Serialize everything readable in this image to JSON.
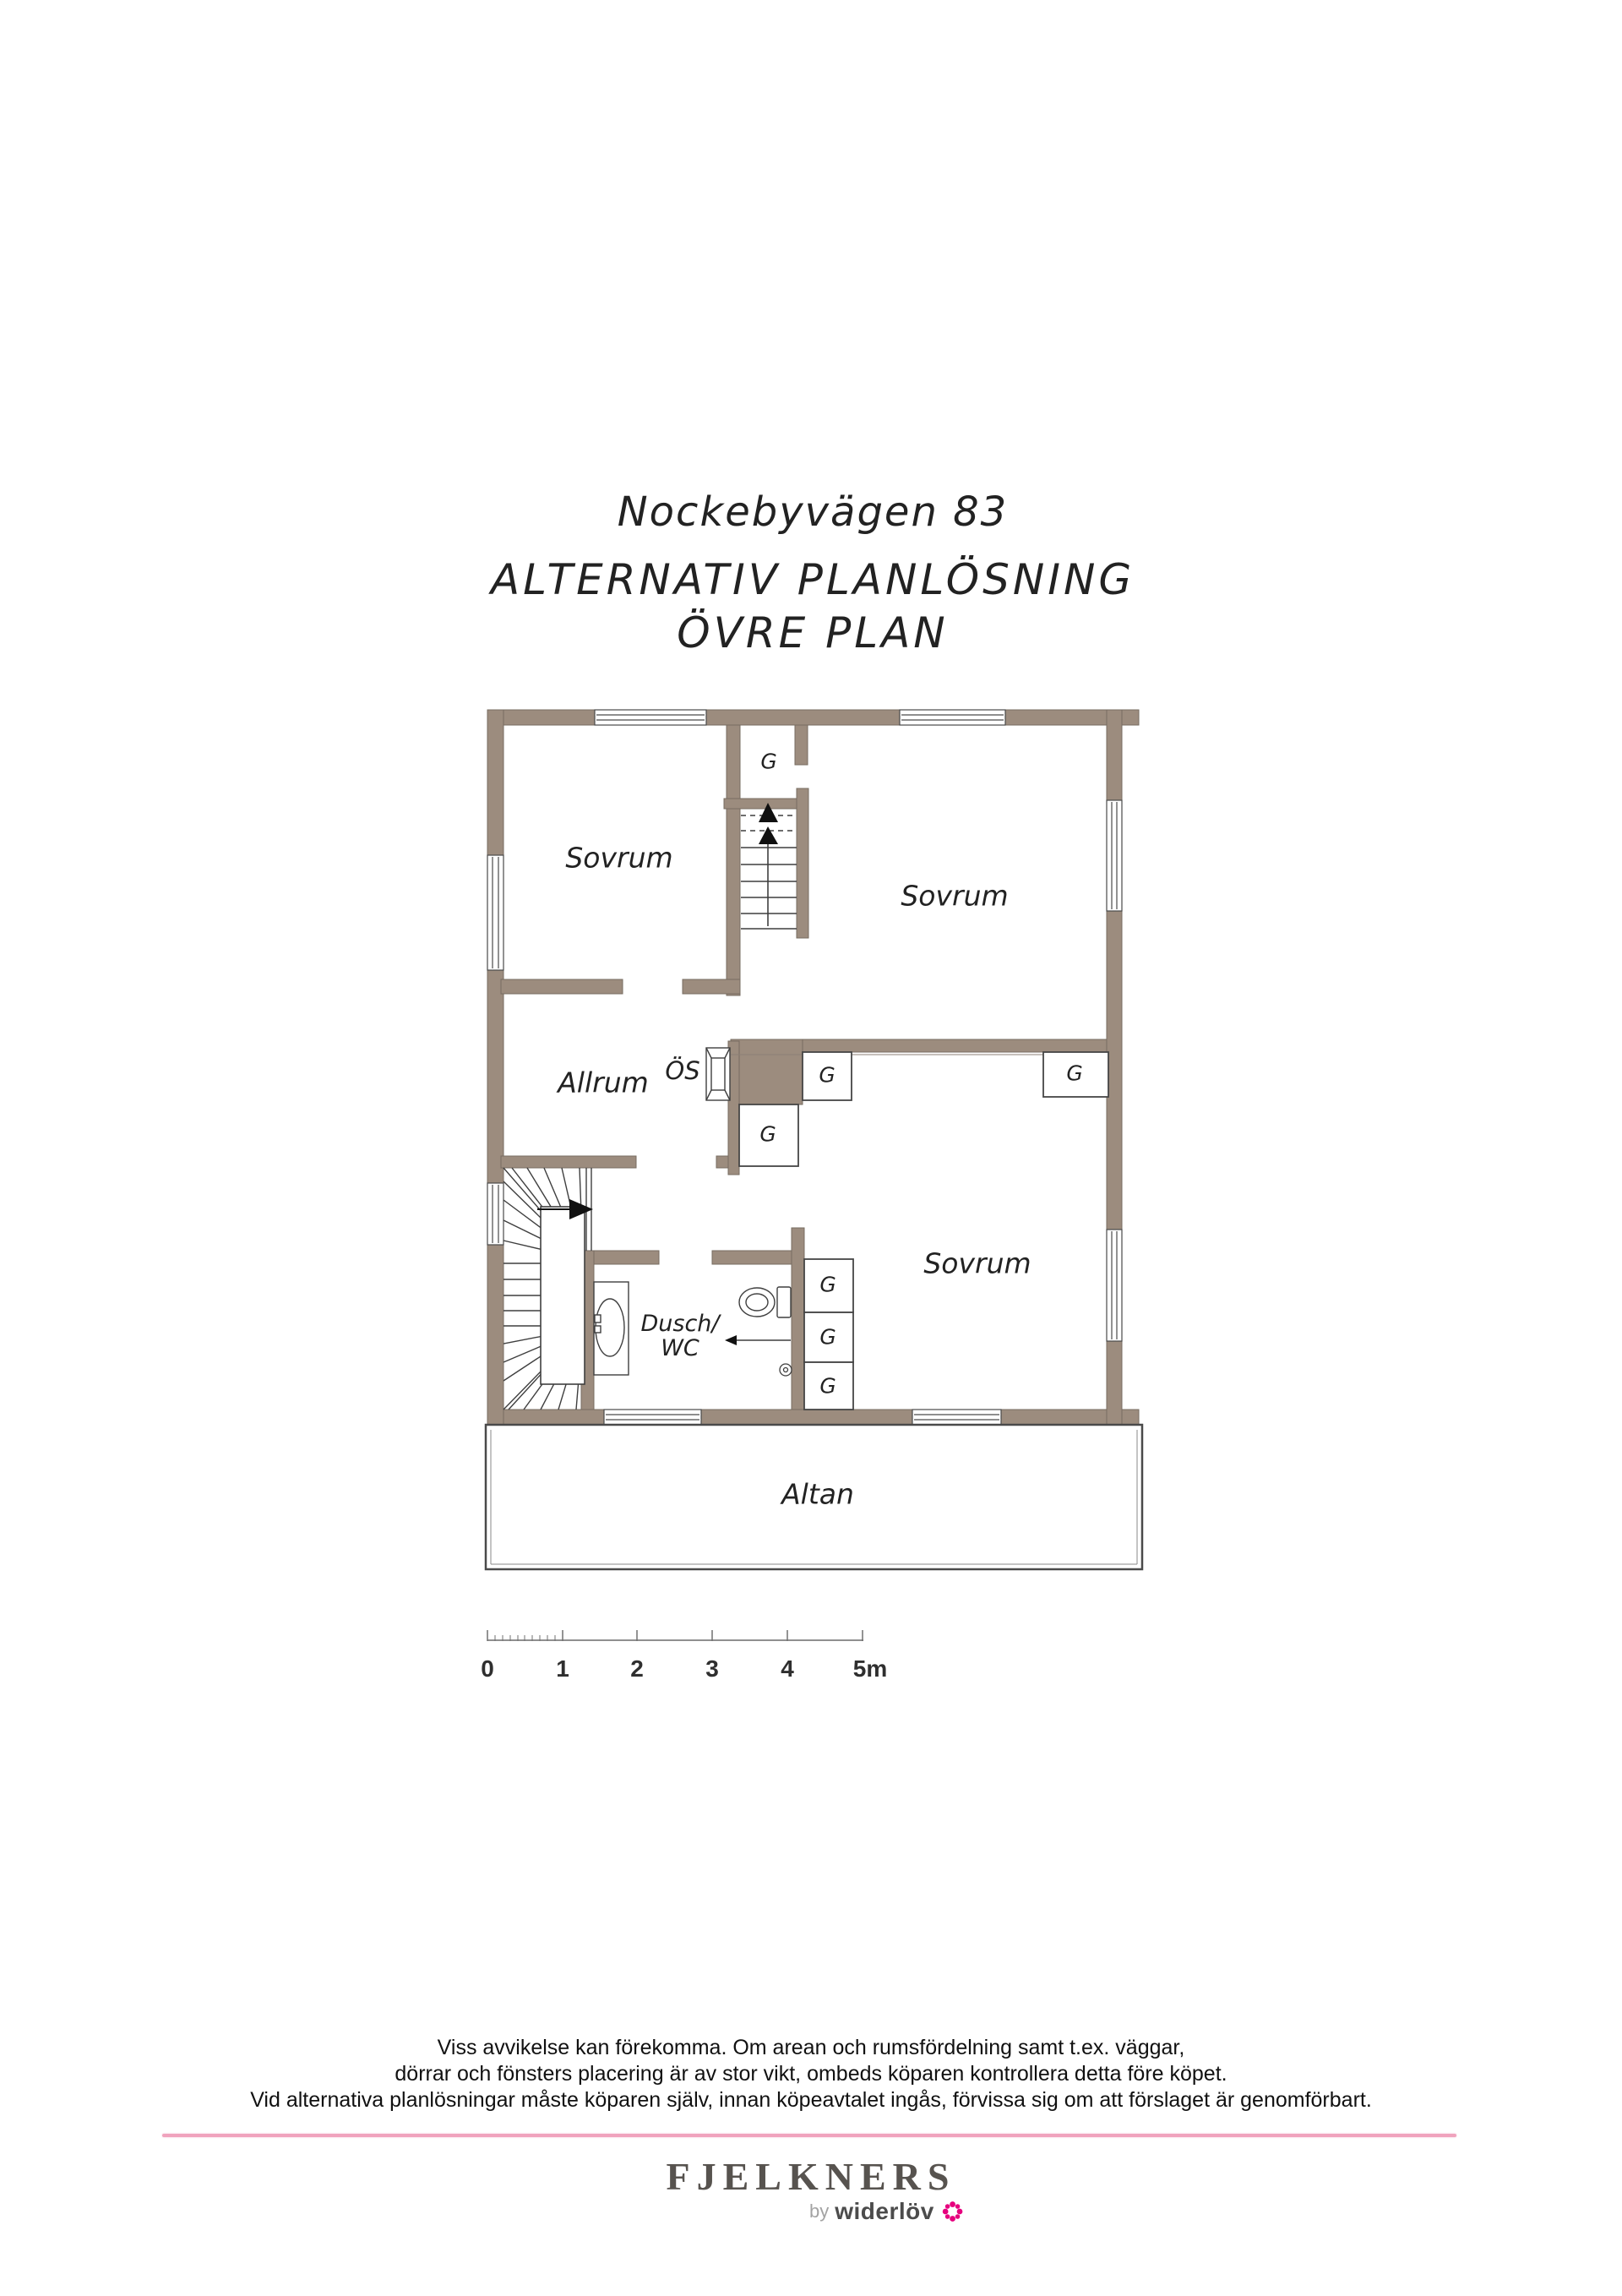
{
  "title": {
    "line1": "Nockebyvägen 83",
    "line2": "ALTERNATIV PLANLÖSNING",
    "line3": "ÖVRE PLAN"
  },
  "plan": {
    "bedroom": "Sovrum",
    "living_room": "Allrum",
    "fireplace_abbr": "ÖS",
    "shower_wc_line1": "Dusch/",
    "shower_wc_line2": "WC",
    "terrace": "Altan",
    "wardrobe": "G"
  },
  "scale_bar": {
    "labels": [
      "0",
      "1",
      "2",
      "3",
      "4",
      "5m"
    ]
  },
  "disclaimer": {
    "line1": "Viss avvikelse kan förekomma. Om arean och rumsfördelning samt t.ex. väggar,",
    "line2": "dörrar och fönsters placering är av stor vikt, ombeds köparen kontrollera detta före köpet.",
    "line3": "Vid alternativa planlösningar måste köparen själv, innan köpeavtalet ingås, förvissa sig om att förslaget är genomförbart."
  },
  "footer": {
    "brand": "FJELKNERS",
    "byline_prefix": "by",
    "byline_name": "widerlöv"
  },
  "colors": {
    "wall_fill": "#9c8c7e",
    "wall_outline": "#776c61",
    "plan_line": "#3f3f3f",
    "divider_pink": "#f0a3bd",
    "brand_gray": "#57534f",
    "brand_magenta": "#e6007e"
  }
}
